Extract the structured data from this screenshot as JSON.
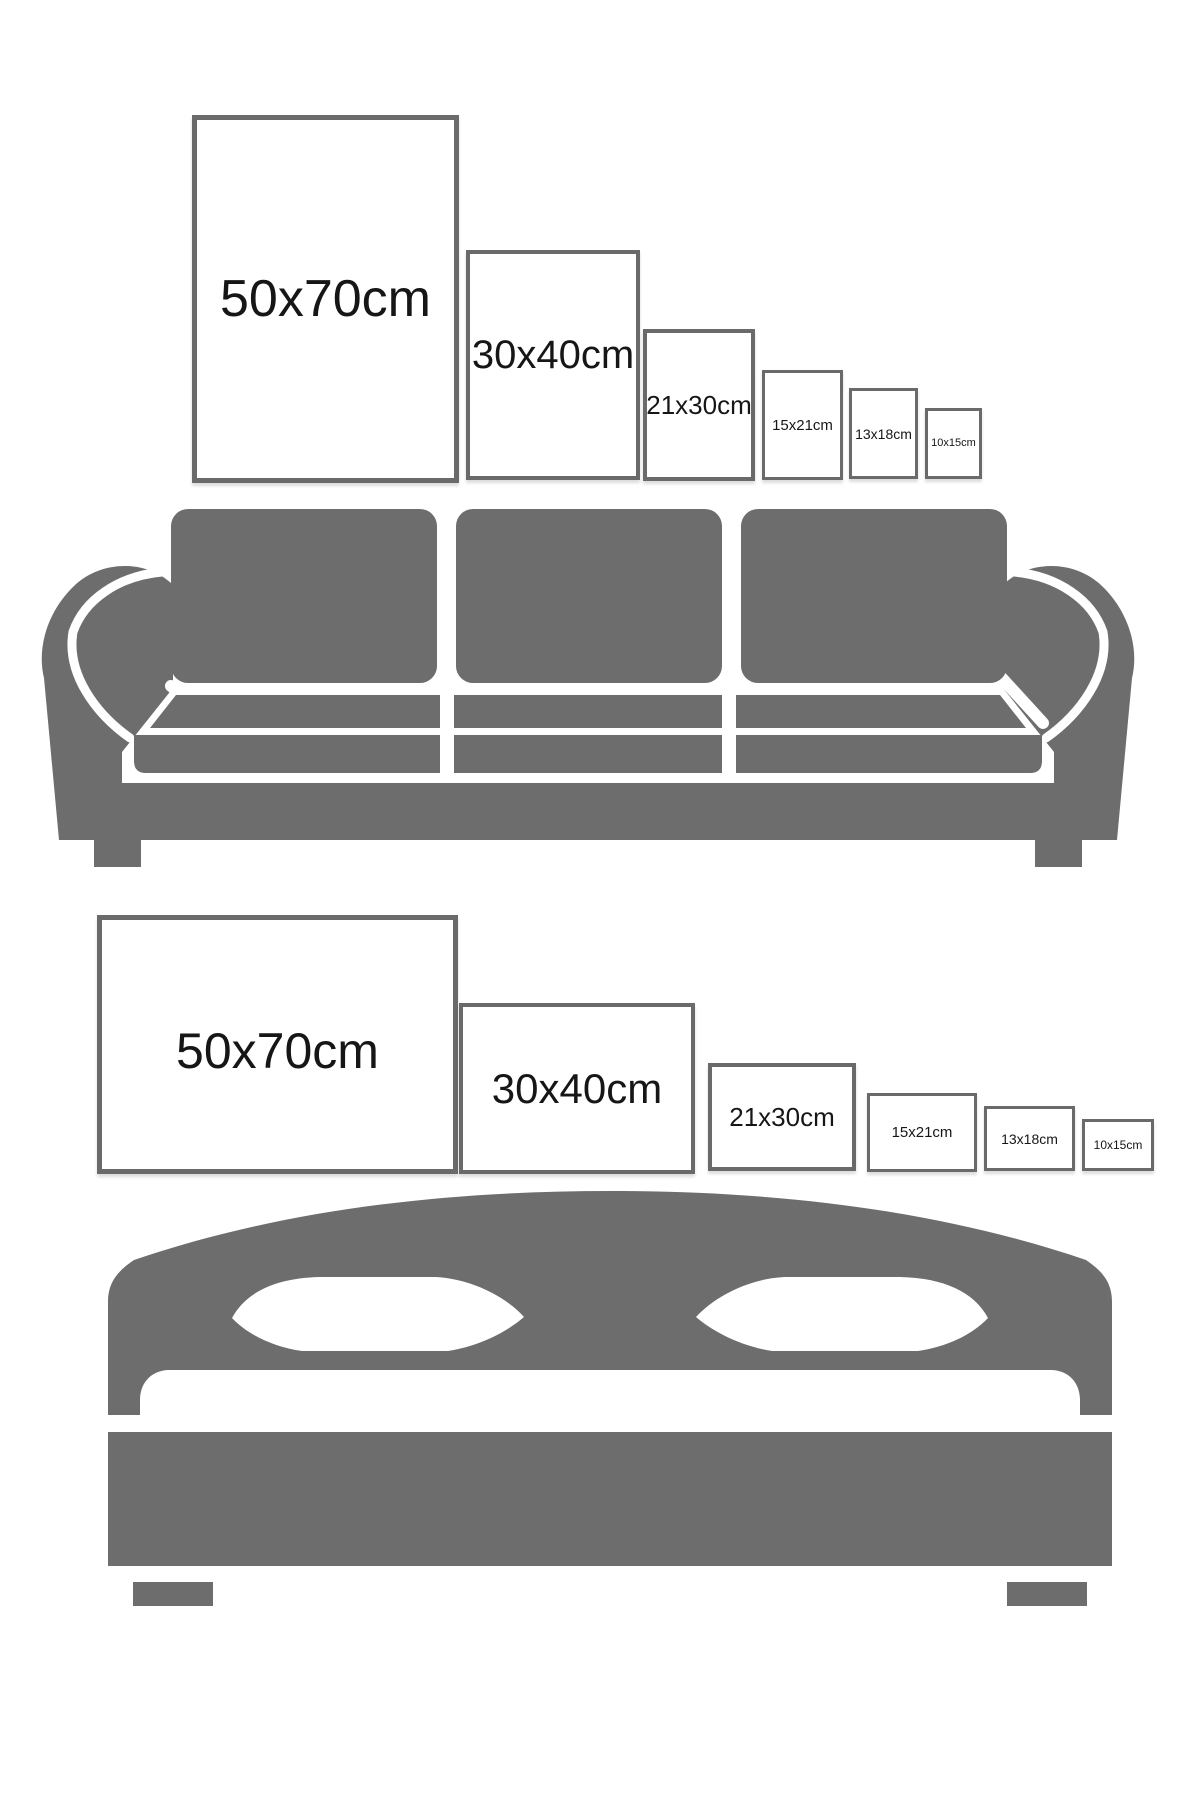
{
  "infographic": {
    "description": "Picture frame size comparison guide shown above a sofa and above a bed",
    "colors": {
      "background": "#ffffff",
      "furniture_gray": "#6d6d6d",
      "frame_border_gray": "#6a6a6a",
      "label_text": "#161616"
    },
    "top_section": {
      "furniture": "sofa",
      "orientation": "portrait",
      "frames": [
        {
          "label": "50x70cm"
        },
        {
          "label": "30x40cm"
        },
        {
          "label": "21x30cm"
        },
        {
          "label": "15x21cm"
        },
        {
          "label": "13x18cm"
        },
        {
          "label": "10x15cm"
        }
      ]
    },
    "bottom_section": {
      "furniture": "bed",
      "orientation": "landscape",
      "frames": [
        {
          "label": "50x70cm"
        },
        {
          "label": "30x40cm"
        },
        {
          "label": "21x30cm"
        },
        {
          "label": "15x21cm"
        },
        {
          "label": "13x18cm"
        },
        {
          "label": "10x15cm"
        }
      ]
    }
  }
}
